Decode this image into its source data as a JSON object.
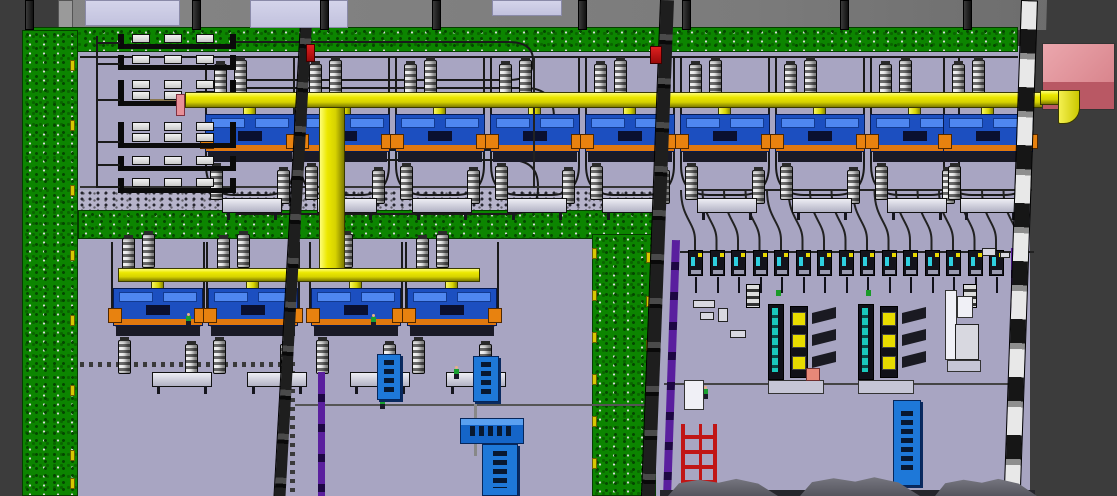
{
  "viewport": {
    "kind": "3d-plant-layout-top-view",
    "description": "isometric factory hall with two machine lines on a yellow overhead pipe, storage racks, feeder stations and rack machines"
  },
  "palette": {
    "void": "#3c3c3c",
    "roof_band": "#7f7f7f",
    "skylight": "#c6c6e2",
    "grass_green": "#0c8500",
    "floor_lavender": "#a8a5c2",
    "pipe_yellow": "#e6e000",
    "machine_blue": "#1c4fc0",
    "machine_orange": "#e0780f",
    "wall_purple": "#5a1f9e",
    "exit_box_pink": "#d98a93",
    "alert_red": "#c11515",
    "teal": "#19c8bc",
    "sign_blue": "#1e78d8"
  },
  "equipment": {
    "upper_line_stations": 9,
    "lower_line_stations": 4,
    "storage_racks": 6,
    "feeder_stations": 16,
    "rack_machines": 2,
    "hoist_stacks": 2,
    "sign_boards": 5,
    "workers": 5,
    "roof_columns": 8,
    "skylights": 3,
    "floor_mounds": 3,
    "red_alarm_boxes": 2,
    "red_ladder_racks": 1,
    "pink_exit_boxes": 1
  }
}
